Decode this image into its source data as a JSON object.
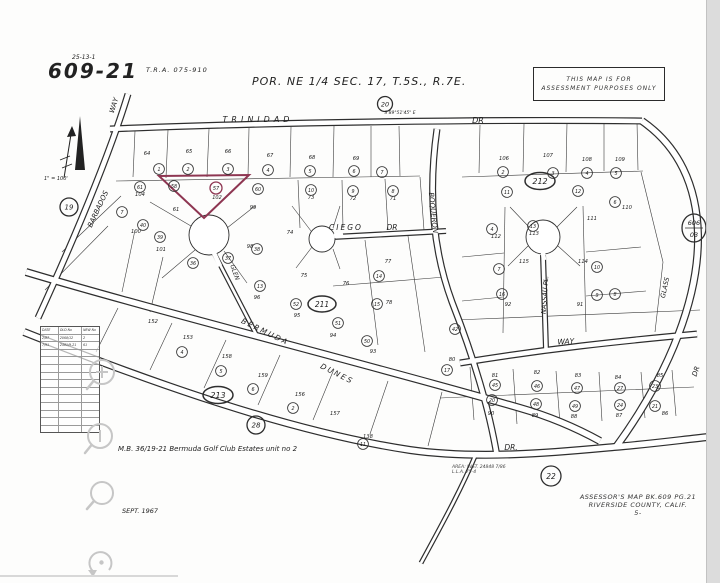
{
  "page": {
    "sheet_ref_small": "25-13-1",
    "book_page": "609-21",
    "tra": "T.R.A. 075-910",
    "title": "POR. NE 1/4 SEC. 17, T.5S., R.7E.",
    "stamp": {
      "line1": "THIS MAP IS FOR",
      "line2": "ASSESSMENT PURPOSES ONLY"
    },
    "scale_note": "1\" = 100'",
    "mb_note": "M.B. 36/19-21  Bermuda Golf Club Estates unit no 2",
    "date_note": "SEPT. 1967",
    "assessor_line1": "ASSESSOR'S MAP BK.609 PG.21",
    "assessor_line2": "RIVERSIDE COUNTY, CALIF.",
    "assessor_mark": "5-",
    "area_note_line1": "AREA: INST. 24848 7/86",
    "area_note_line2": "L.L.A. 75-4"
  },
  "revision_table": {
    "headers": [
      "DATE",
      "OLD No",
      "NEW No"
    ],
    "rows": [
      [
        "2/87",
        "2068/12",
        "2"
      ],
      [
        "7/91",
        "2481/9-21",
        "61"
      ]
    ],
    "empty_rows": 11
  },
  "toolbar": {
    "buttons": [
      {
        "name": "zoom-in",
        "icon": "magnifier-plus-icon"
      },
      {
        "name": "zoom-out",
        "icon": "magnifier-minus-icon"
      },
      {
        "name": "inspect",
        "icon": "magnifier-icon"
      },
      {
        "name": "reset-view",
        "icon": "reset-arrow-icon"
      }
    ]
  },
  "map": {
    "ink_color": "#2e2e2e",
    "highlight_color": "#8e3652",
    "highlight_parcel": {
      "points": "159,176 249,175 204,218",
      "circled": "57",
      "lot": "102",
      "cx": 216,
      "cy": 188
    },
    "roads": [
      {
        "id": "trinidad-dr",
        "d": "M110,129 C250,123 480,119 642,121",
        "w": 7
      },
      {
        "id": "barbados-way",
        "d": "M128,94 C114,140 85,215 38,318",
        "w": 7
      },
      {
        "id": "glass-dr",
        "d": "M642,121 C678,146 697,185 698,235 C699,295 672,370 616,447",
        "w": 8
      },
      {
        "id": "boqueron",
        "d": "M437,129 C429,185 431,245 452,302 C470,348 488,402 497,456",
        "w": 7
      },
      {
        "id": "ciego-dr",
        "d": "M333,237 L446,231",
        "w": 6
      },
      {
        "id": "glen",
        "d": "M214,253 L256,334",
        "w": 5
      },
      {
        "id": "nassau-pl",
        "d": "M543,255 L546,349",
        "w": 6
      },
      {
        "id": "way",
        "d": "M460,363 C545,349 620,341 697,334",
        "w": 7
      },
      {
        "id": "bermuda-dunes-dr",
        "d": "M26,272 C160,312 360,362 520,408 C555,418 580,430 600,441",
        "w": 8
      },
      {
        "id": "dr-south",
        "d": "M24,332 C150,382 290,432 410,450 C480,460 560,452 614,447 C650,444 680,440 708,437",
        "w": 8
      },
      {
        "id": "boqueron-south-stub",
        "d": "M476,454 C460,492 441,526 421,563",
        "w": 5
      }
    ],
    "culdesacs": [
      {
        "cx": 322,
        "cy": 239,
        "r": 13,
        "plug": "334 236 343 234"
      },
      {
        "cx": 209,
        "cy": 235,
        "r": 20,
        "plug": "214 253 220 266"
      },
      {
        "cx": 543,
        "cy": 237,
        "r": 17,
        "plug": "543 252 544 260"
      }
    ],
    "street_labels": [
      {
        "t": "TRINIDAD",
        "x": 258,
        "y": 122,
        "s": 8,
        "ls": 4
      },
      {
        "t": "DR",
        "x": 478,
        "y": 123,
        "s": 8
      },
      {
        "t": "WAY",
        "x": 116,
        "y": 106,
        "s": 7,
        "rot": -72
      },
      {
        "t": "BARBADOS",
        "x": 100,
        "y": 210,
        "s": 7,
        "rot": -65
      },
      {
        "t": "BOQUERON",
        "x": 431,
        "y": 213,
        "s": 7,
        "rot": 84
      },
      {
        "t": "CIEGO",
        "x": 346,
        "y": 230,
        "s": 7.5,
        "ls": 2
      },
      {
        "t": "DR",
        "x": 392,
        "y": 230,
        "s": 7.5
      },
      {
        "t": "GLEN",
        "x": 233,
        "y": 273,
        "s": 6,
        "rot": 70
      },
      {
        "t": "NASSAU  PL.",
        "x": 547,
        "y": 295,
        "s": 6.5,
        "rot": -86
      },
      {
        "t": "BERMUDA",
        "x": 264,
        "y": 334,
        "s": 7.5,
        "rot": 26,
        "ls": 2
      },
      {
        "t": "DUNES",
        "x": 336,
        "y": 376,
        "s": 7.5,
        "rot": 27,
        "ls": 2
      },
      {
        "t": "WAY",
        "x": 566,
        "y": 344,
        "s": 7.5,
        "rot": -3
      },
      {
        "t": "DR.",
        "x": 511,
        "y": 450,
        "s": 7.5
      },
      {
        "t": "DR",
        "x": 698,
        "y": 372,
        "s": 7,
        "rot": -72
      },
      {
        "t": "GLASS",
        "x": 667,
        "y": 288,
        "s": 6.5,
        "rot": -78
      },
      {
        "t": "S 89°51'45\" E",
        "x": 400,
        "y": 114,
        "s": 4.5
      }
    ],
    "block_markers": [
      {
        "shape": "circle",
        "t": "20",
        "x": 385,
        "y": 104,
        "r": 7.5,
        "s": 6.5
      },
      {
        "shape": "circle",
        "t": "19",
        "x": 69,
        "y": 207,
        "r": 9,
        "s": 7
      },
      {
        "shape": "oval",
        "t": "212",
        "x": 540,
        "y": 181,
        "rx": 15,
        "ry": 8.5,
        "s": 8
      },
      {
        "shape": "oval",
        "t": "211",
        "x": 322,
        "y": 304,
        "rx": 14,
        "ry": 8,
        "s": 7.5
      },
      {
        "shape": "oval",
        "t": "213",
        "x": 218,
        "y": 395,
        "rx": 15,
        "ry": 8.5,
        "s": 8
      },
      {
        "shape": "circle",
        "t": "28",
        "x": 256,
        "y": 425,
        "r": 9,
        "s": 7
      },
      {
        "shape": "circle",
        "t": "22",
        "x": 551,
        "y": 476,
        "r": 10,
        "s": 7.5
      },
      {
        "shape": "split",
        "t": "606",
        "t2": "03",
        "x": 694,
        "y": 228,
        "r": 13,
        "s": 6.5
      }
    ],
    "circled_lots": [
      {
        "t": "1",
        "x": 159,
        "y": 169
      },
      {
        "t": "2",
        "x": 188,
        "y": 169
      },
      {
        "t": "3",
        "x": 228,
        "y": 169
      },
      {
        "t": "4",
        "x": 268,
        "y": 170
      },
      {
        "t": "5",
        "x": 310,
        "y": 171
      },
      {
        "t": "6",
        "x": 354,
        "y": 171
      },
      {
        "t": "7",
        "x": 382,
        "y": 172
      },
      {
        "t": "2",
        "x": 503,
        "y": 172
      },
      {
        "t": "3",
        "x": 553,
        "y": 173
      },
      {
        "t": "4",
        "x": 587,
        "y": 173
      },
      {
        "t": "5",
        "x": 616,
        "y": 173
      },
      {
        "t": "61",
        "x": 140,
        "y": 187
      },
      {
        "t": "58",
        "x": 174,
        "y": 186
      },
      {
        "t": "60",
        "x": 258,
        "y": 189
      },
      {
        "t": "10",
        "x": 311,
        "y": 190
      },
      {
        "t": "9",
        "x": 353,
        "y": 191
      },
      {
        "t": "8",
        "x": 393,
        "y": 191
      },
      {
        "t": "40",
        "x": 143,
        "y": 225
      },
      {
        "t": "39",
        "x": 160,
        "y": 237
      },
      {
        "t": "38",
        "x": 257,
        "y": 249
      },
      {
        "t": "37",
        "x": 228,
        "y": 258
      },
      {
        "t": "36",
        "x": 193,
        "y": 263
      },
      {
        "t": "7",
        "x": 122,
        "y": 212
      },
      {
        "t": "14",
        "x": 379,
        "y": 276
      },
      {
        "t": "13",
        "x": 260,
        "y": 286
      },
      {
        "t": "52",
        "x": 296,
        "y": 304
      },
      {
        "t": "51",
        "x": 338,
        "y": 323
      },
      {
        "t": "15",
        "x": 377,
        "y": 304
      },
      {
        "t": "50",
        "x": 367,
        "y": 341
      },
      {
        "t": "11",
        "x": 507,
        "y": 192
      },
      {
        "t": "12",
        "x": 578,
        "y": 191
      },
      {
        "t": "6",
        "x": 615,
        "y": 202
      },
      {
        "t": "4",
        "x": 492,
        "y": 229
      },
      {
        "t": "13",
        "x": 533,
        "y": 226
      },
      {
        "t": "10",
        "x": 597,
        "y": 267
      },
      {
        "t": "7",
        "x": 499,
        "y": 269
      },
      {
        "t": "16",
        "x": 502,
        "y": 294
      },
      {
        "t": "9",
        "x": 597,
        "y": 295
      },
      {
        "t": "8",
        "x": 615,
        "y": 294
      },
      {
        "t": "42",
        "x": 455,
        "y": 329
      },
      {
        "t": "17",
        "x": 447,
        "y": 370
      },
      {
        "t": "45",
        "x": 495,
        "y": 385
      },
      {
        "t": "46",
        "x": 537,
        "y": 386
      },
      {
        "t": "47",
        "x": 577,
        "y": 388
      },
      {
        "t": "27",
        "x": 620,
        "y": 388
      },
      {
        "t": "23",
        "x": 655,
        "y": 386
      },
      {
        "t": "20",
        "x": 492,
        "y": 400
      },
      {
        "t": "48",
        "x": 536,
        "y": 404
      },
      {
        "t": "49",
        "x": 575,
        "y": 406
      },
      {
        "t": "24",
        "x": 620,
        "y": 405
      },
      {
        "t": "21",
        "x": 655,
        "y": 406
      },
      {
        "t": "4",
        "x": 182,
        "y": 352
      },
      {
        "t": "5",
        "x": 221,
        "y": 371
      },
      {
        "t": "6",
        "x": 253,
        "y": 389
      },
      {
        "t": "2",
        "x": 293,
        "y": 408
      },
      {
        "t": "11",
        "x": 363,
        "y": 444
      }
    ],
    "lot_numbers": [
      {
        "t": "64",
        "x": 147,
        "y": 155
      },
      {
        "t": "65",
        "x": 189,
        "y": 153
      },
      {
        "t": "66",
        "x": 228,
        "y": 153
      },
      {
        "t": "67",
        "x": 270,
        "y": 157
      },
      {
        "t": "68",
        "x": 312,
        "y": 159
      },
      {
        "t": "69",
        "x": 356,
        "y": 160
      },
      {
        "t": "106",
        "x": 504,
        "y": 160
      },
      {
        "t": "107",
        "x": 548,
        "y": 157
      },
      {
        "t": "108",
        "x": 587,
        "y": 161
      },
      {
        "t": "109",
        "x": 620,
        "y": 161
      },
      {
        "t": "104",
        "x": 140,
        "y": 196
      },
      {
        "t": "73",
        "x": 311,
        "y": 199
      },
      {
        "t": "72",
        "x": 353,
        "y": 200
      },
      {
        "t": "71",
        "x": 393,
        "y": 200
      },
      {
        "t": "61",
        "x": 176,
        "y": 211
      },
      {
        "t": "99",
        "x": 253,
        "y": 209
      },
      {
        "t": "100",
        "x": 136,
        "y": 233
      },
      {
        "t": "101",
        "x": 161,
        "y": 251
      },
      {
        "t": "98",
        "x": 250,
        "y": 248
      },
      {
        "t": "74",
        "x": 290,
        "y": 234
      },
      {
        "t": "75",
        "x": 304,
        "y": 277
      },
      {
        "t": "76",
        "x": 346,
        "y": 285
      },
      {
        "t": "77",
        "x": 388,
        "y": 263
      },
      {
        "t": "78",
        "x": 389,
        "y": 304
      },
      {
        "t": "96",
        "x": 257,
        "y": 299
      },
      {
        "t": "95",
        "x": 297,
        "y": 317
      },
      {
        "t": "94",
        "x": 333,
        "y": 337
      },
      {
        "t": "93",
        "x": 373,
        "y": 353
      },
      {
        "t": "110",
        "x": 627,
        "y": 209
      },
      {
        "t": "111",
        "x": 592,
        "y": 220
      },
      {
        "t": "112",
        "x": 496,
        "y": 238
      },
      {
        "t": "113",
        "x": 534,
        "y": 235
      },
      {
        "t": "114",
        "x": 583,
        "y": 263
      },
      {
        "t": "115",
        "x": 524,
        "y": 263
      },
      {
        "t": "92",
        "x": 508,
        "y": 306
      },
      {
        "t": "91",
        "x": 580,
        "y": 306
      },
      {
        "t": "80",
        "x": 452,
        "y": 361
      },
      {
        "t": "81",
        "x": 495,
        "y": 377
      },
      {
        "t": "82",
        "x": 537,
        "y": 374
      },
      {
        "t": "83",
        "x": 578,
        "y": 377
      },
      {
        "t": "84",
        "x": 618,
        "y": 379
      },
      {
        "t": "85",
        "x": 660,
        "y": 377
      },
      {
        "t": "90",
        "x": 491,
        "y": 415
      },
      {
        "t": "89",
        "x": 535,
        "y": 417
      },
      {
        "t": "88",
        "x": 574,
        "y": 418
      },
      {
        "t": "87",
        "x": 619,
        "y": 417
      },
      {
        "t": "86",
        "x": 665,
        "y": 415
      },
      {
        "t": "152",
        "x": 153,
        "y": 323
      },
      {
        "t": "153",
        "x": 188,
        "y": 339
      },
      {
        "t": "158",
        "x": 227,
        "y": 358
      },
      {
        "t": "159",
        "x": 263,
        "y": 377
      },
      {
        "t": "156",
        "x": 300,
        "y": 396
      },
      {
        "t": "157",
        "x": 335,
        "y": 415
      },
      {
        "t": "138",
        "x": 368,
        "y": 438
      }
    ],
    "parcel_lines": [
      "135 131 133 177",
      "168 130 166 178",
      "209 129 207 177",
      "249 128 248 176",
      "291 127 290 177",
      "334 126 333 177",
      "371 126 371 177",
      "399 126 400 176",
      "116 181 420 176",
      "480 125 479 173",
      "524 124 523 172",
      "567 123 566 172",
      "604 123 604 171",
      "637 122 638 170",
      "462 177 643 171",
      "298 180 300 228",
      "342 180 343 228",
      "385 179 388 230",
      "420 177 424 230",
      "121 196 62 252",
      "108 226 45 290",
      "135 230 122 292",
      "163 257 150 312",
      "191 226 150 202",
      "195 250 162 278",
      "224 251 247 283",
      "227 228 255 206",
      "311 231 292 206",
      "312 247 296 268",
      "333 249 340 269",
      "333 228 340 206",
      "365 240 378 345",
      "408 236 425 352",
      "333 286 445 277",
      "505 207 503 333",
      "583 206 586 332",
      "529 227 510 207",
      "557 227 577 207",
      "528 246 508 266",
      "558 246 580 266",
      "462 257 504 253",
      "586 252 641 247",
      "462 301 503 297",
      "586 296 646 291",
      "641 172 663 262",
      "663 262 655 332",
      "455 320 700 310",
      "440 398 694 387",
      "470 367 474 420",
      "513 369 517 424",
      "556 371 560 424",
      "599 372 602 421",
      "641 372 645 418",
      "672 370 676 416",
      "118 308 96 352",
      "172 323 150 370",
      "226 340 204 388",
      "280 355 258 405",
      "334 369 313 420",
      "388 381 370 434",
      "442 392 428 446"
    ]
  }
}
